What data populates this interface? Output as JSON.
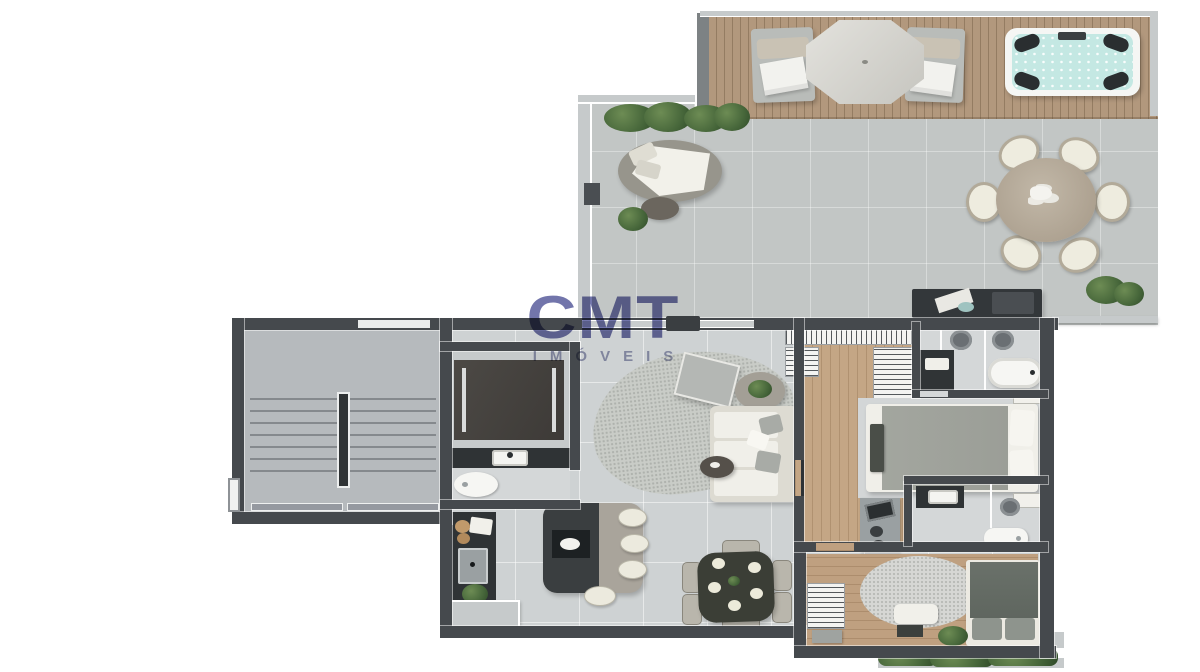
{
  "watermark": {
    "brand": "CMT",
    "tagline": "IMÓVEIS"
  },
  "colors": {
    "wall": "#45494d",
    "wall-light": "#c6cacb",
    "terrace": "#c2c6c5",
    "deck": "#b2987d",
    "floor": "#ced2d3",
    "floor-stair": "#b6babd",
    "bath-floor": "#d4d7d8",
    "wood": "#c4a685",
    "wood2": "#bfa080",
    "counter-dark": "#2f3335",
    "furn-white": "#f0efe9",
    "furn-gray": "#b3b6b3",
    "rug": "#c9ccc7",
    "water": "#c4e8e3",
    "plant": "#4c6c3c",
    "duvet": "#9b9e97",
    "duvet-dark": "#5f665f",
    "table-dark": "#3b3e36",
    "watermark-brand": "rgba(74,78,148,0.78)",
    "watermark-tagline": "rgba(118,122,162,0.7)"
  }
}
